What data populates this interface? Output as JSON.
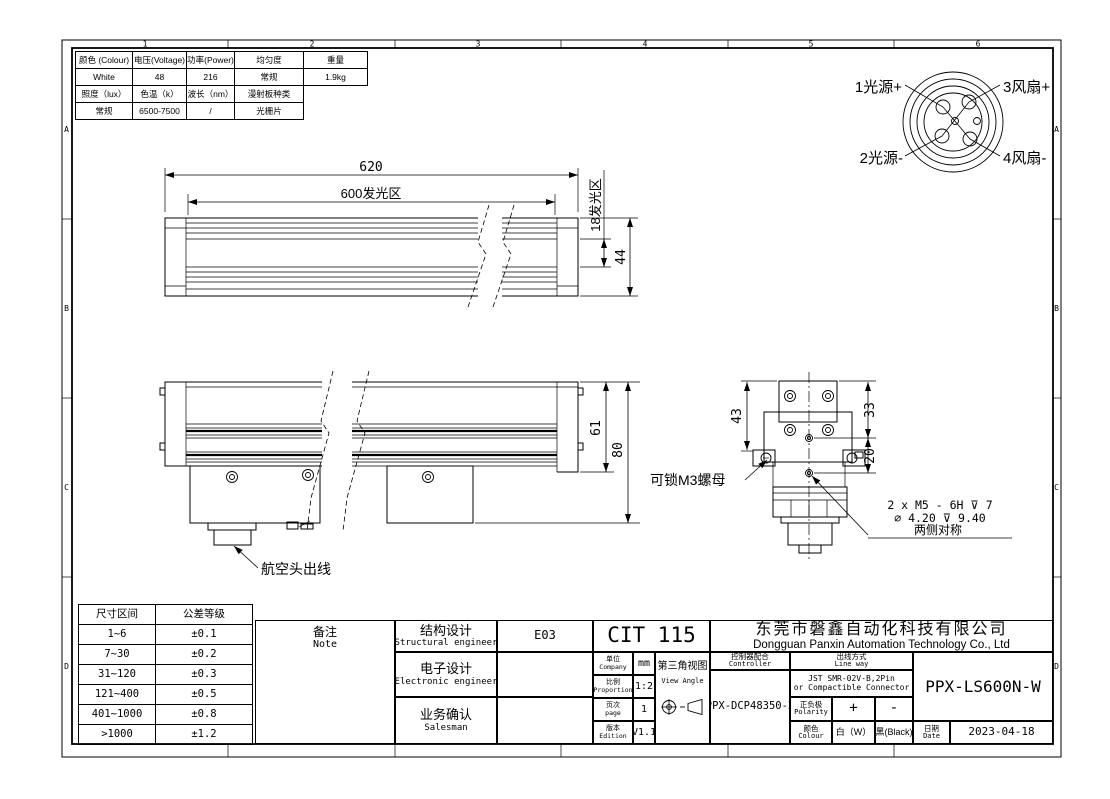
{
  "frame": {
    "top_zones": [
      "1",
      "2",
      "3",
      "4",
      "5",
      "6"
    ],
    "side_zones": [
      "A",
      "B",
      "C",
      "D"
    ]
  },
  "spec_table": {
    "r0": [
      "颜色 (Colour)",
      "电压(Voltage)",
      "功率(Power)",
      "均匀度",
      "重量"
    ],
    "r1": [
      "White",
      "48",
      "216",
      "常规",
      "1.9kg"
    ],
    "r2": [
      "照度（lux）",
      "色温（k）",
      "波长（nm）",
      "漫射板种类"
    ],
    "r3": [
      "常规",
      "6500-7500",
      "/",
      "光栅片"
    ]
  },
  "connector_pinout": {
    "pin1": "1光源+",
    "pin3": "3风扇+",
    "pin2": "2光源-",
    "pin4": "4风扇-"
  },
  "dims": {
    "overall_length": "620",
    "emit_length": "600发光区",
    "emit_width": "18发光区",
    "body_width": "44",
    "body_height": "61",
    "total_height": "80",
    "end_h1": "43",
    "end_h2": "33",
    "end_h3": "20"
  },
  "annotations": {
    "aviation_connector": "航空头出线",
    "m3_nut": "可锁M3螺母",
    "thread_line1": "2 x  M5 - 6H ⊽ 7",
    "thread_line2": "⌀ 4.20  ⊽ 9.40",
    "thread_line3": "两侧对称"
  },
  "tolerance_table": {
    "header": [
      "尺寸区间",
      "公差等级"
    ],
    "rows": [
      [
        "1~6",
        "±0.1"
      ],
      [
        "7~30",
        "±0.2"
      ],
      [
        "31~120",
        "±0.3"
      ],
      [
        "121~400",
        "±0.5"
      ],
      [
        "401~1000",
        "±0.8"
      ],
      [
        ">1000",
        "±1.2"
      ]
    ]
  },
  "title_block": {
    "note_cn": "备注",
    "note_en": "Note",
    "structural_cn": "结构设计",
    "structural_en": "Structural engineer",
    "structural_value": "E03",
    "electronic_cn": "电子设计",
    "electronic_en": "Electronic engineer",
    "electronic_value": "",
    "salesman_cn": "业务确认",
    "salesman_en": "Salesman",
    "salesman_value": "",
    "drawing_code": "CIT 115",
    "company_cn": "东莞市磐鑫自动化科技有限公司",
    "company_en": "Dongguan Panxin Automation Technology Co., Ltd",
    "unit_cn": "单位",
    "unit_en": "Company",
    "unit_value": "mm",
    "proportion_cn": "比例",
    "proportion_en": "Proportion",
    "proportion_value": "1:2",
    "page_cn": "页次",
    "page_en": "page",
    "page_value": "1",
    "edition_cn": "版本",
    "edition_en": "Edition",
    "edition_value": "V1.1",
    "view_angle_cn": "第三角视图",
    "view_angle_en": "View Angle",
    "controller_cn": "控制器配合",
    "controller_en": "Controller",
    "controller_value": "PPX-DCP48350-2",
    "lineway_cn": "出线方式",
    "lineway_en": "Line way",
    "lineway_value1": "JST SMR-02V-B,2Pin",
    "lineway_value2": "or Compactible Connector",
    "polarity_cn": "正负极",
    "polarity_en": "Polarity",
    "polarity_plus": "+",
    "polarity_minus": "-",
    "colour_cn": "颜色",
    "colour_en": "Colour",
    "colour_white": "白（W）",
    "colour_black": "黑(Black)",
    "part_number": "PPX-LS600N-W",
    "date_cn": "日期",
    "date_en": "Date",
    "date_value": "2023-04-18"
  }
}
